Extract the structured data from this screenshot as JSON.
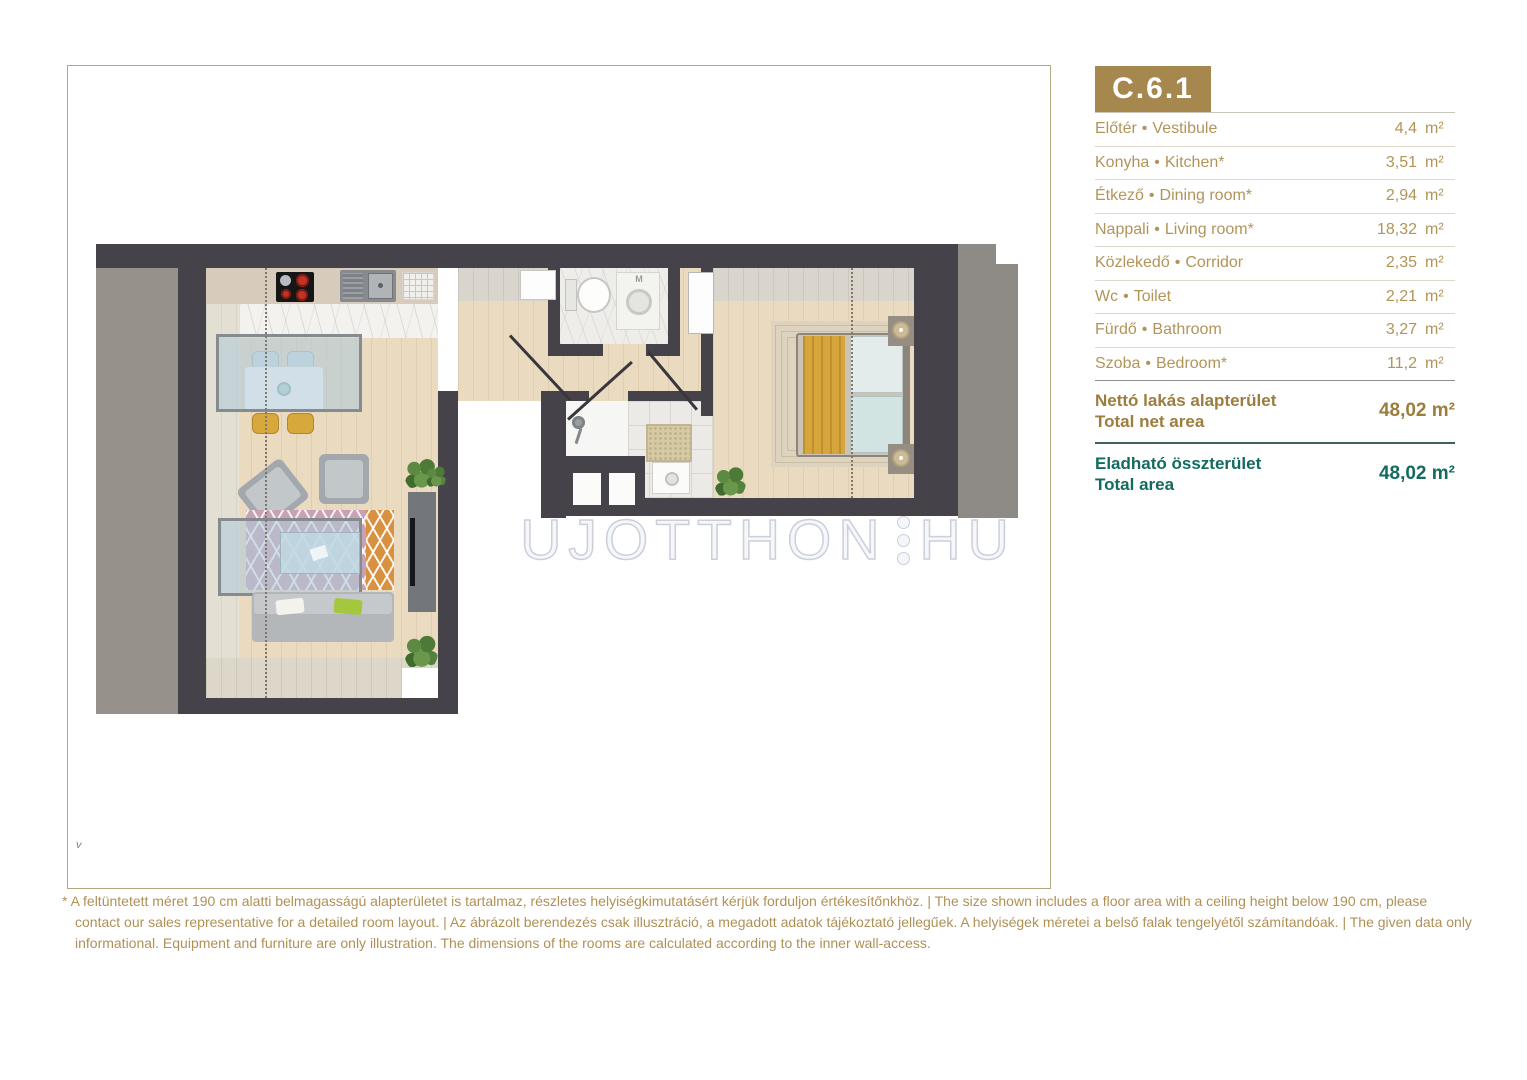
{
  "unit_code": "C.6.1",
  "separator": "•",
  "area_unit": "m²",
  "rooms": [
    {
      "hu": "Előtér",
      "en": "Vestibule",
      "area": "4,4"
    },
    {
      "hu": "Konyha",
      "en": "Kitchen*",
      "area": "3,51"
    },
    {
      "hu": "Étkező",
      "en": "Dining room*",
      "area": "2,94"
    },
    {
      "hu": "Nappali",
      "en": "Living room*",
      "area": "18,32"
    },
    {
      "hu": "Közlekedő",
      "en": "Corridor",
      "area": "2,35"
    },
    {
      "hu": "Wc",
      "en": "Toilet",
      "area": "2,21"
    },
    {
      "hu": "Fürdő",
      "en": "Bathroom",
      "area": "3,27"
    },
    {
      "hu": "Szoba",
      "en": "Bedroom*",
      "area": "11,2"
    }
  ],
  "totals": {
    "net": {
      "hu": "Nettó lakás alapterület",
      "en": "Total net area",
      "value": "48,02 m²"
    },
    "sellable": {
      "hu": "Eladható összterület",
      "en": "Total area",
      "value": "48,02 m²"
    }
  },
  "plan": {
    "watermark_left": "UJOTTHON",
    "watermark_right": "HU",
    "washer_label": "M",
    "corner_mark": "v"
  },
  "colors": {
    "accent_gold": "#a6874e",
    "accent_teal": "#136a5e",
    "wall": "#46424a"
  },
  "disclaimer": "* A feltüntetett méret 190 cm alatti belmagasságú alapterületet is tartalmaz, részletes helyiségkimutatásért kérjük forduljon értékesítőnkhöz. | The size shown includes a floor area with a ceiling height below 190 cm, please contact our sales representative for a detailed room layout. | Az ábrázolt berendezés csak illusztráció, a megadott adatok tájékoztató jellegűek. A helyiségek méretei a belső falak tengelyétől számítandóak. | The given data only informational. Equipment and furniture are only illustration. The dimensions of the rooms are calculated according to the inner wall-access."
}
